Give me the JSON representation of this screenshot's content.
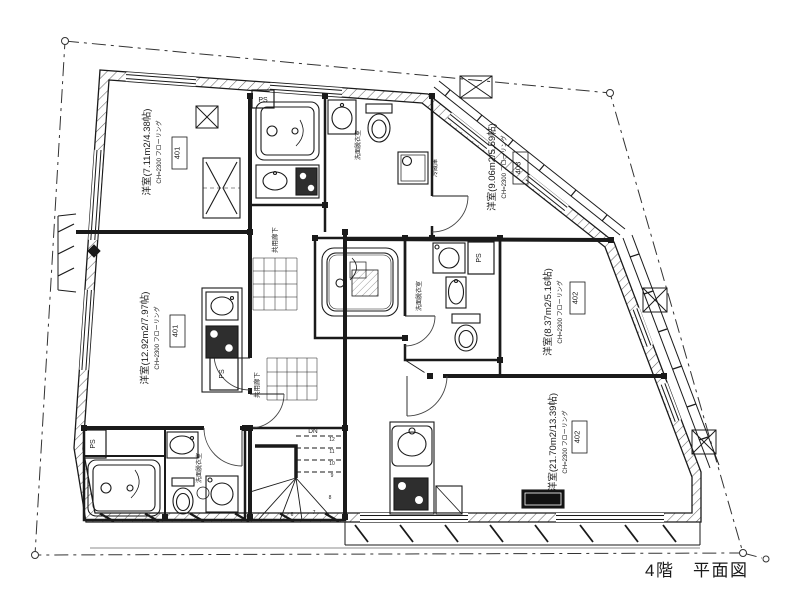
{
  "title": "4階　平面図",
  "colors": {
    "line": "#1a1a1a",
    "background": "#ffffff"
  },
  "rooms": [
    {
      "label": "洋室(7.11m2/4.38帖)",
      "spec": "CH=2300 フローリング",
      "num": "401"
    },
    {
      "label": "洋室(12.92m2/7.97帖)",
      "spec": "CH=2300 フローリング",
      "num": "401"
    },
    {
      "label": "洋室(9.06m2/5.59帖)",
      "spec": "CH=2300 フローリング",
      "num": "403"
    },
    {
      "label": "洋室(8.37m2/5.16帖)",
      "spec": "CH=2300 フローリング",
      "num": "402"
    },
    {
      "label": "洋室(21.70m2/13.39帖)",
      "spec": "CH=2300 フローリング",
      "num": "402"
    }
  ],
  "labels": {
    "washroom": "洗面脱衣室",
    "corridor": "共用廊下",
    "ps": "PS",
    "refrigerator": "冷蔵庫",
    "down": "DN",
    "stair_steps": [
      "6",
      "7",
      "8",
      "9",
      "10",
      "11",
      "12"
    ]
  }
}
